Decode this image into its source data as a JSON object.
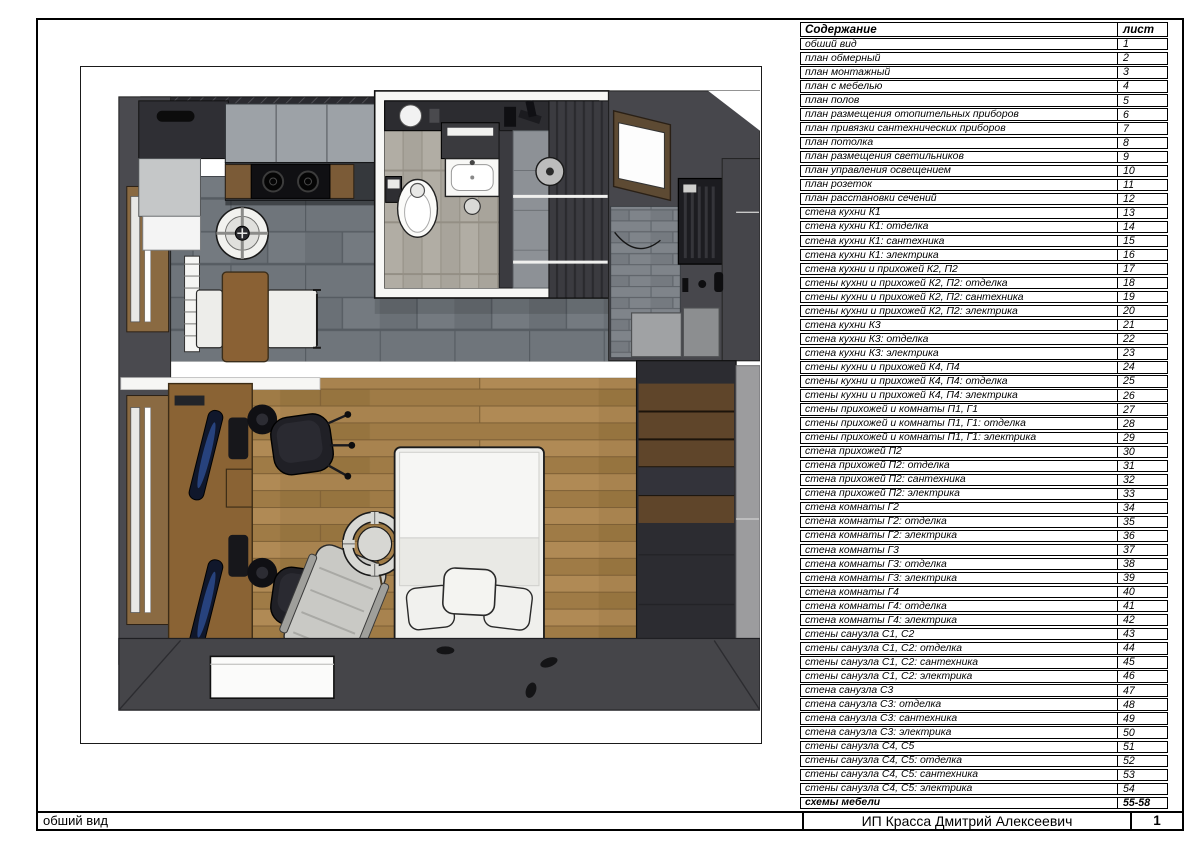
{
  "contents": {
    "title": "Содержание",
    "sheet_col": "лист",
    "rows": [
      {
        "label": "обший вид",
        "sheet": "1"
      },
      {
        "label": "план обмерный",
        "sheet": "2"
      },
      {
        "label": "план монтажный",
        "sheet": "3"
      },
      {
        "label": "план с мебелью",
        "sheet": "4"
      },
      {
        "label": "план полов",
        "sheet": "5"
      },
      {
        "label": "план размещения отопительных приборов",
        "sheet": "6"
      },
      {
        "label": "план привязки сантехнических приборов",
        "sheet": "7"
      },
      {
        "label": "план потолка",
        "sheet": "8"
      },
      {
        "label": "план размещения светильников",
        "sheet": "9"
      },
      {
        "label": "план управления освещением",
        "sheet": "10"
      },
      {
        "label": "план розеток",
        "sheet": "11"
      },
      {
        "label": "план расстановки сечений",
        "sheet": "12"
      },
      {
        "label": "стена кухни К1",
        "sheet": "13"
      },
      {
        "label": "стена кухни К1: отделка",
        "sheet": "14"
      },
      {
        "label": "стена кухни К1: сантехника",
        "sheet": "15"
      },
      {
        "label": "стена кухни К1: электрика",
        "sheet": "16"
      },
      {
        "label": "стена кухни и прихожей К2, П2",
        "sheet": "17"
      },
      {
        "label": "стены кухни и прихожей К2, П2: отделка",
        "sheet": "18"
      },
      {
        "label": "стены кухни и прихожей К2, П2:  сантехника",
        "sheet": "19"
      },
      {
        "label": "стены кухни и прихожей К2, П2:  электрика",
        "sheet": "20"
      },
      {
        "label": "стена кухни К3",
        "sheet": "21"
      },
      {
        "label": "стена кухни К3: отделка",
        "sheet": "22"
      },
      {
        "label": "стена кухни К3: электрика",
        "sheet": "23"
      },
      {
        "label": "стены кухни и прихожей К4, П4",
        "sheet": "24"
      },
      {
        "label": "стены кухни и прихожей К4, П4: отделка",
        "sheet": "25"
      },
      {
        "label": "стены кухни и прихожей К4, П4: электрика",
        "sheet": "26"
      },
      {
        "label": "стены прихожей и комнаты П1, Г1",
        "sheet": "27"
      },
      {
        "label": "стены прихожей и комнаты П1, Г1: отделка",
        "sheet": "28"
      },
      {
        "label": "стены прихожей и комнаты П1, Г1: электрика",
        "sheet": "29"
      },
      {
        "label": "стена прихожей П2",
        "sheet": "30"
      },
      {
        "label": "стена прихожей П2: отделка",
        "sheet": "31"
      },
      {
        "label": "стена прихожей П2: сантехника",
        "sheet": "32"
      },
      {
        "label": "стена прихожей П2: электрика",
        "sheet": "33"
      },
      {
        "label": "стена комнаты Г2",
        "sheet": "34"
      },
      {
        "label": "стена комнаты Г2: отделка",
        "sheet": "35"
      },
      {
        "label": "стена комнаты Г2: электрика",
        "sheet": "36"
      },
      {
        "label": "стена комнаты Г3",
        "sheet": "37"
      },
      {
        "label": "стена комнаты Г3: отделка",
        "sheet": "38"
      },
      {
        "label": "стена комнаты Г3: электрика",
        "sheet": "39"
      },
      {
        "label": "стена комнаты Г4",
        "sheet": "40"
      },
      {
        "label": "стена комнаты Г4: отделка",
        "sheet": "41"
      },
      {
        "label": "стена комнаты Г4: электрика",
        "sheet": "42"
      },
      {
        "label": "стены санузла С1, С2",
        "sheet": "43"
      },
      {
        "label": "стены санузла С1, С2: отделка",
        "sheet": "44"
      },
      {
        "label": "стены санузла С1, С2: сантехника",
        "sheet": "45"
      },
      {
        "label": "стены санузла С1, С2: электрика",
        "sheet": "46"
      },
      {
        "label": "стена санузла С3",
        "sheet": "47"
      },
      {
        "label": "стена санузла С3: отделка",
        "sheet": "48"
      },
      {
        "label": "стена санузла С3: сантехника",
        "sheet": "49"
      },
      {
        "label": "стена санузла С3: электрика",
        "sheet": "50"
      },
      {
        "label": "стены санузла С4, С5",
        "sheet": "51"
      },
      {
        "label": "стены санузла С4, С5: отделка",
        "sheet": "52"
      },
      {
        "label": "стены санузла С4, С5: сантехника",
        "sheet": "53"
      },
      {
        "label": "стены санузла С4, С5: электрика",
        "sheet": "54"
      },
      {
        "label": "схемы мебели",
        "sheet": "55-58",
        "bold": true
      }
    ]
  },
  "title_block": {
    "view_label": "обший вид",
    "company": "ИП Красса Дмитрий Алексеевич",
    "sheet_number": "1"
  },
  "colors": {
    "page_border": "#000000",
    "wall_dark": "#46464b",
    "tile_floor": "#6f757b",
    "wood_floor": "#a8834f",
    "cabinet_gray": "#9da2a7",
    "white_fixture": "#f6f6f4"
  }
}
